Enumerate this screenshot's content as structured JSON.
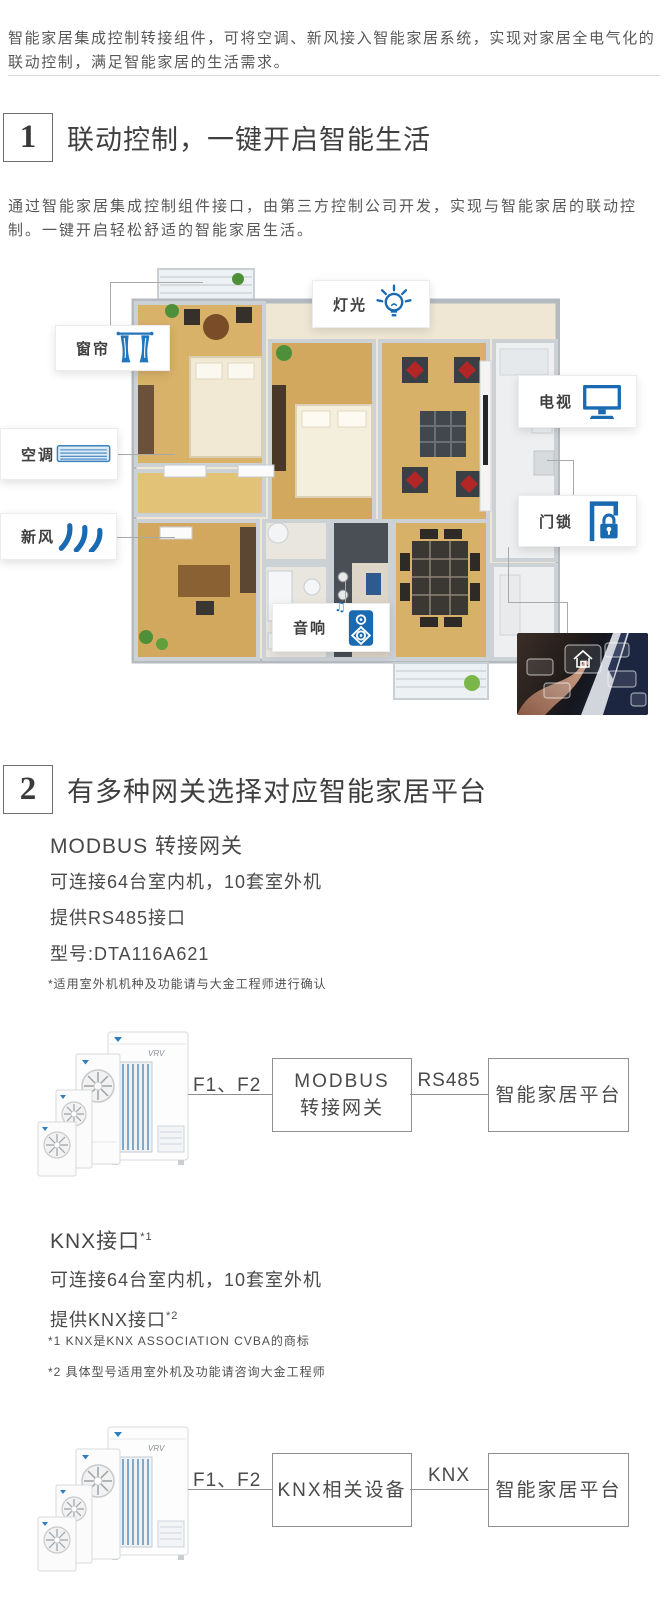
{
  "colors": {
    "accent_blue": "#1a6ab2",
    "text_dark": "#3f3f3f",
    "text_gray": "#595757"
  },
  "intro": "智能家居集成控制转接组件，可将空调、新风接入智能家居系统，实现对家居全电气化的联动控制，满足智能家居的生活需求。",
  "section1": {
    "number": "1",
    "title": "联动控制，一键开启智能生活",
    "description": "通过智能家居集成控制组件接口，由第三方控制公司开发，实现与智能家居的联动控制。一键开启轻松舒适的智能家居生活。",
    "callouts": [
      {
        "label": "窗帘",
        "icon": "curtain-icon"
      },
      {
        "label": "灯光",
        "icon": "light-bulb-icon"
      },
      {
        "label": "空调",
        "icon": "ac-vent-icon"
      },
      {
        "label": "新风",
        "icon": "wind-icon"
      },
      {
        "label": "电视",
        "icon": "tv-icon"
      },
      {
        "label": "门锁",
        "icon": "door-lock-icon"
      },
      {
        "label": "音响",
        "icon": "speaker-icon"
      }
    ],
    "music_note": "♫"
  },
  "section2": {
    "number": "2",
    "title": "有多种网关选择对应智能家居平台",
    "modbus": {
      "subtitle": "MODBUS 转接网关",
      "spec1": "可连接64台室内机，10套室外机",
      "spec2": "提供RS485接口",
      "spec3": "型号:DTA116A621",
      "footnote": "*适用室外机机种及功能请与大金工程师进行确认",
      "diagram": {
        "device_label": "VRV",
        "wire1": "F1、F2",
        "node1_line1": "MODBUS",
        "node1_line2": "转接网关",
        "wire2": "RS485",
        "node2": "智能家居平台"
      }
    },
    "knx": {
      "subtitle": "KNX接口",
      "subtitle_sup": "*1",
      "spec1": "可连接64台室内机，10套室外机",
      "spec2": "提供KNX接口",
      "spec2_sup": "*2",
      "footnote1": "*1 KNX是KNX ASSOCIATION CVBA的商标",
      "footnote2": "*2 具体型号适用室外机及功能请咨询大金工程师",
      "diagram": {
        "device_label": "VRV",
        "wire1": "F1、F2",
        "node1": "KNX相关设备",
        "wire2": "KNX",
        "node2": "智能家居平台"
      }
    }
  }
}
